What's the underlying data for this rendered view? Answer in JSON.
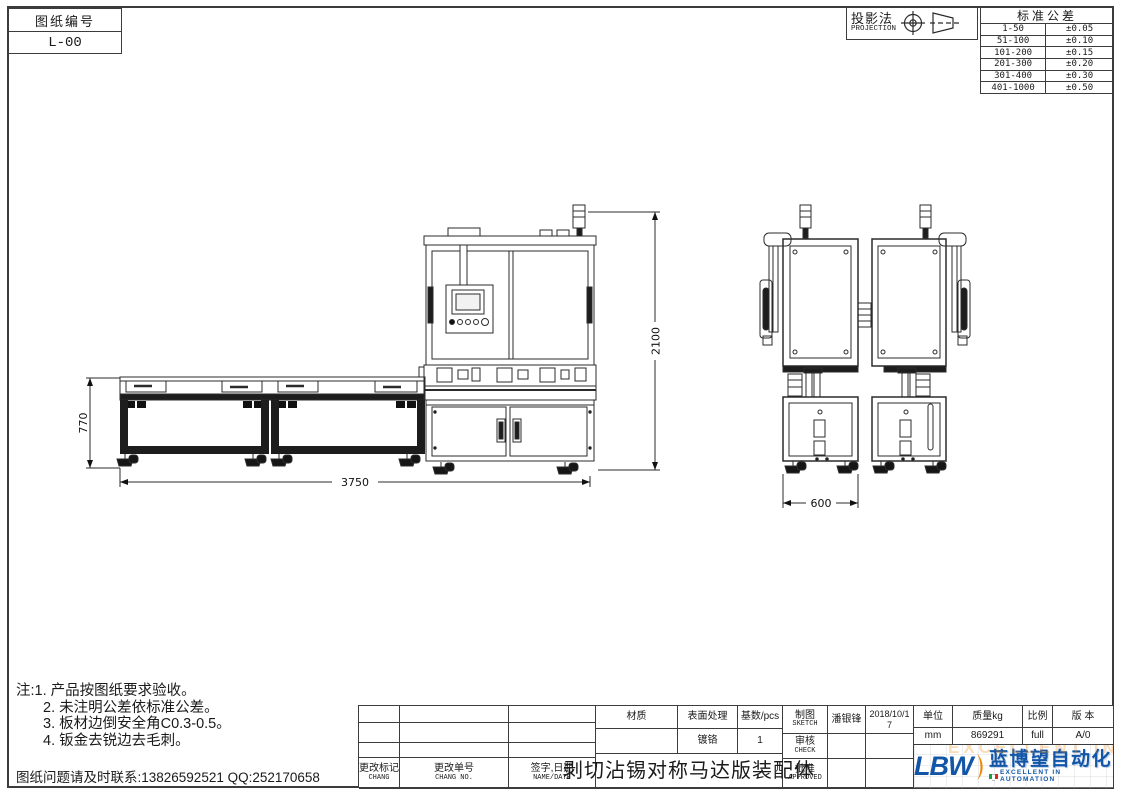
{
  "sheet": {
    "drawing_no_label": "图纸编号",
    "drawing_no": "L-00",
    "projection_label": "投影法",
    "projection_sublabel": "PROJECTION",
    "tolerance_title": "标准公差",
    "tolerance_rows": [
      [
        "1-50",
        "±0.05"
      ],
      [
        "51-100",
        "±0.10"
      ],
      [
        "101-200",
        "±0.15"
      ],
      [
        "201-300",
        "±0.20"
      ],
      [
        "301-400",
        "±0.30"
      ],
      [
        "401-1000",
        "±0.50"
      ]
    ]
  },
  "dimensions": {
    "machine_height": "2100",
    "table_height": "770",
    "total_length": "3750",
    "unit_width": "600"
  },
  "notes": {
    "lines": [
      "注:1. 产品按图纸要求验收。",
      "2. 未注明公差依标准公差。",
      "3. 板材边倒安全角C0.3-0.5。",
      "4. 钣金去锐边去毛刺。"
    ],
    "contact": "图纸问题请及时联系:13826592521 QQ:252170658"
  },
  "titleblock": {
    "change_mark": "更改标记",
    "change_mark_en": "CHANG",
    "change_no": "更改单号",
    "change_no_en": "CHANG NO.",
    "sign_date": "签字,日期",
    "sign_date_en": "NAME/DATE",
    "material_label": "材质",
    "material_value": "",
    "surface_label": "表面处理",
    "surface_value": "镀铬",
    "qty_label": "基数/pcs",
    "qty_value": "1",
    "title": "剥切沾锡对称马达版装配体",
    "sketch_label": "制图",
    "sketch_en": "SKETCH",
    "sketch_name": "潘银锋",
    "sketch_date": "2018/10/17",
    "check_label": "审核",
    "check_en": "CHECK",
    "approve_label": "批准",
    "approve_en": "APPROVED",
    "unit_label": "单位",
    "unit_value": "mm",
    "mass_label": "质量kg",
    "mass_value": "869291",
    "scale_label": "比例",
    "scale_value": "full",
    "version_label": "版 本",
    "version_value": "A/0"
  },
  "logo": {
    "abbr": "LBW",
    "name": "蓝博望自动化",
    "tagline": "EXCELLENT IN AUTOMATION",
    "blue": "#1356a8",
    "orange": "#f08300"
  }
}
